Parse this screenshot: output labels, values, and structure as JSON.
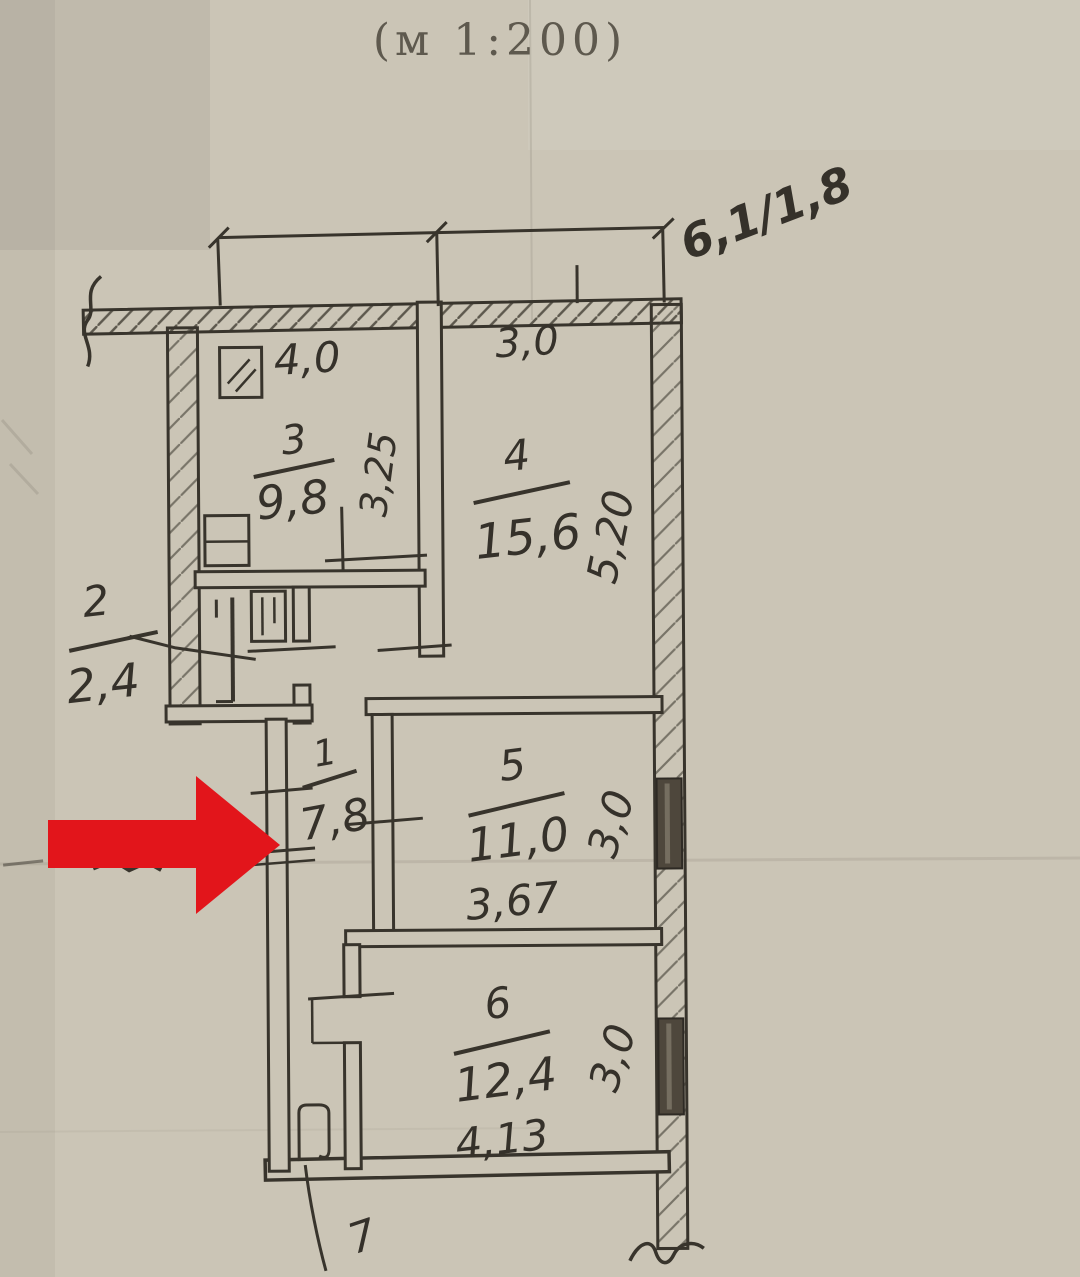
{
  "page": {
    "scale_label": "(м 1:200)",
    "corner_note": "6,1/1,8"
  },
  "rooms": [
    {
      "number": "3",
      "area": "9,8"
    },
    {
      "number": "4",
      "area": "15,6"
    },
    {
      "number": "2",
      "area": "2,4"
    },
    {
      "number": "1",
      "area": "7,8"
    },
    {
      "number": "5",
      "area": "11,0"
    },
    {
      "number": "6",
      "area": "12,4"
    },
    {
      "number": "7",
      "area": ""
    }
  ],
  "dimensions": {
    "top_width_left": "4,0",
    "top_width_right": "3,0",
    "kitchen_depth": "3,25",
    "room4_depth": "5,20",
    "room5_depth": "3,0",
    "room5_width": "3,67",
    "room6_depth": "3,0",
    "room6_width": "4,13"
  },
  "colors": {
    "arrow": "#e2151b",
    "ink": "#38342c",
    "paper": "#cbc5b6"
  }
}
